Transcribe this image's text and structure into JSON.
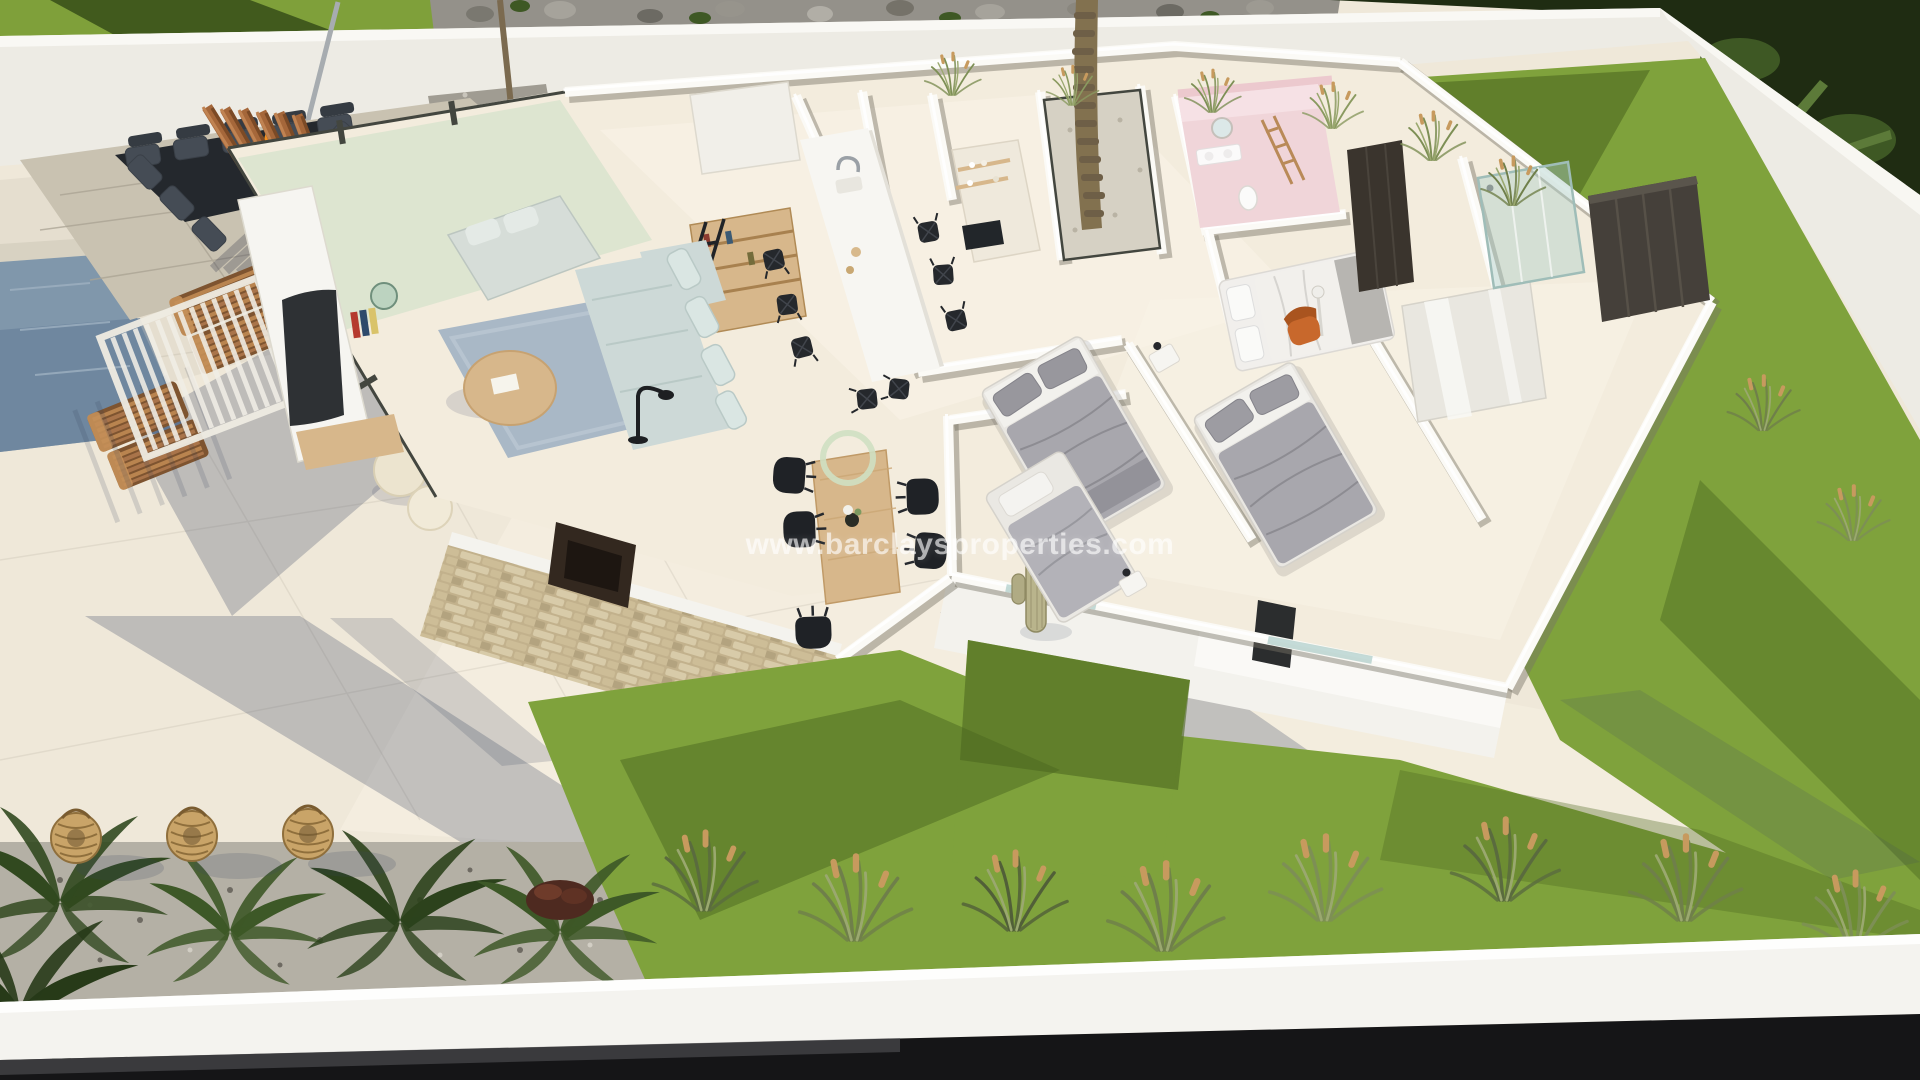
{
  "watermark": {
    "text": "www.barclaysproperties.com"
  },
  "scene": {
    "type": "3d-floorplan-render",
    "description": "Aerial dollhouse view of a modern single-storey villa: walled garden, terrace with sunken fire-pit lounge and pergola, pool edge, glass-walled living room, kitchen island, three bedrooms, pink bathroom, lawns with ornamental grasses",
    "regions": [
      "top-foliage",
      "rock-border",
      "perimeter-wall-top",
      "perimeter-wall-right",
      "boundary-lawn",
      "gravel-patch",
      "tree",
      "pool",
      "stone-deck",
      "sunken-lounge",
      "fire-pit",
      "pergola-fins",
      "sun-loungers",
      "slatted-pergola",
      "terrace",
      "living-room",
      "glass-wall",
      "tv-wall",
      "bookshelf",
      "sofa",
      "rug",
      "coffee-table",
      "poufs",
      "kitchen-island",
      "dining-chairs",
      "kitchen-counter",
      "courtyard-palm",
      "wood-dining-table",
      "hall-cactus",
      "bedroom-1",
      "bedroom-2",
      "bedroom-3",
      "bedroom-4",
      "orange-armchair",
      "wardrobes",
      "pink-bathroom",
      "shower-enclosure",
      "stone-feature-wall",
      "south-facade",
      "garden-gravel-bed",
      "palm-shrubs",
      "rattan-lanterns",
      "lawn-band",
      "ornamental-grasses",
      "boundary-wall-front",
      "watermark"
    ]
  },
  "palette": {
    "terrace": "#efe8d9",
    "terrace_light": "#f7f1e4",
    "terrace_shade": "#ded7c8",
    "wall_face": "#edebe4",
    "wall_top": "#f9f8f4",
    "wall_shade": "#d6d3ca",
    "floor": "#f3ecdd",
    "floor_light": "#faf4e8",
    "lawn": "#7fa23c",
    "lawn_shade": "#4c681f",
    "foliage_dark": "#1f2c12",
    "foliage_mid": "#3e5824",
    "pool": "#8097ab",
    "pool_deep": "#68809a",
    "stone_deck": "#c9c2b1",
    "pit": "#24282d",
    "sofa_dark": "#454c55",
    "fire": "#f29022",
    "corten": "#a5673a",
    "corten_dark": "#7b4a26",
    "wood_light": "#d7b78b",
    "wood": "#b98a58",
    "glass": "#cfe2cc",
    "frame_dark": "#43463f",
    "rug": "#a9b8c6",
    "sofa_blue": "#cdd9d7",
    "black_furniture": "#212428",
    "bed_grey": "#a8a7ad",
    "bed_white": "#f1efec",
    "pink": "#f0d5d9",
    "orange_chair": "#c8682c",
    "stone_a": "#d8cba9",
    "stone_b": "#c2b18c",
    "gravel": "#b4b0a5",
    "band_white": "#f4f3ef",
    "band_dark": "#151517",
    "shadow": "rgba(60,70,98,0.27)",
    "grass_olive": "#6f7f4a",
    "seed_tan": "#c79a5e",
    "rattan": "#c9a468",
    "watermark_color": "rgba(255,255,255,0.62)"
  }
}
